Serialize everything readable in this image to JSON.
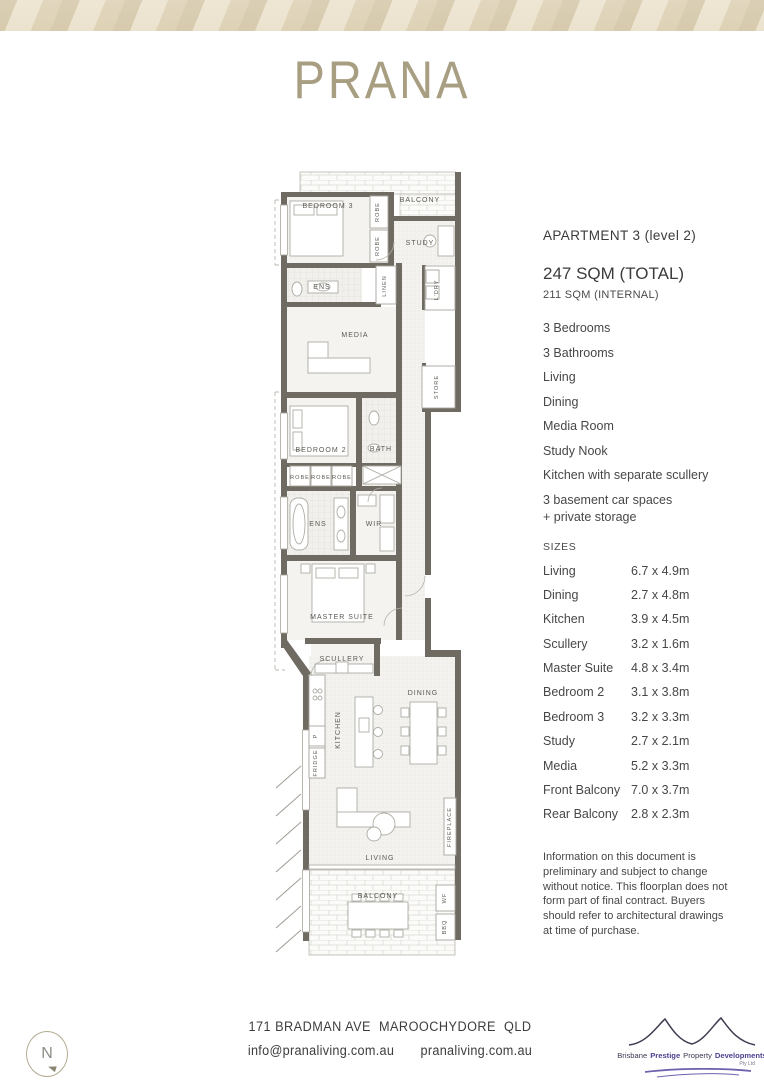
{
  "brand": {
    "logo_text": "PRANA"
  },
  "apartment": {
    "title": "APARTMENT 3 (level 2)",
    "area_total": "247 SQM (TOTAL)",
    "area_internal": "211 SQM (INTERNAL)",
    "features": [
      "3 Bedrooms",
      "3 Bathrooms",
      "Living",
      "Dining",
      "Media Room",
      "Study Nook",
      "Kitchen with separate scullery",
      "3 basement car spaces",
      "+ private storage"
    ]
  },
  "sizes": {
    "heading": "SIZES",
    "rows": [
      {
        "room": "Living",
        "dim": "6.7 x 4.9m"
      },
      {
        "room": "Dining",
        "dim": "2.7 x 4.8m"
      },
      {
        "room": "Kitchen",
        "dim": "3.9 x 4.5m"
      },
      {
        "room": "Scullery",
        "dim": "3.2 x 1.6m"
      },
      {
        "room": "Master Suite",
        "dim": "4.8 x 3.4m"
      },
      {
        "room": "Bedroom 2",
        "dim": "3.1 x 3.8m"
      },
      {
        "room": "Bedroom 3",
        "dim": "3.2 x 3.3m"
      },
      {
        "room": "Study",
        "dim": "2.7 x 2.1m"
      },
      {
        "room": "Media",
        "dim": "5.2 x 3.3m"
      },
      {
        "room": "Front Balcony",
        "dim": "7.0 x 3.7m"
      },
      {
        "room": "Rear Balcony",
        "dim": "2.8 x 2.3m"
      }
    ]
  },
  "disclaimer": "Information on this document is preliminary and subject to change without notice. This floorplan does not form part of final contract. Buyers should refer to architectural drawings at time of purchase.",
  "footer": {
    "address": "171 BRADMAN AVE  MAROOCHYDORE  QLD",
    "email": "info@pranaliving.com.au",
    "website": "pranaliving.com.au",
    "compass_letter": "N",
    "developer": {
      "word1": "Brisbane",
      "word2": "Prestige",
      "word3": "Property",
      "word4": "Developments",
      "sub": "Pty Ltd"
    }
  },
  "floorplan": {
    "labels": {
      "bedroom3": "BEDROOM 3",
      "robe": "ROBE",
      "balcony": "BALCONY",
      "study": "STUDY",
      "ens": "ENS",
      "linen": "LINEN",
      "laundry": "L'DRY",
      "media": "MEDIA",
      "store": "STORE",
      "bedroom2": "BEDROOM 2",
      "bath": "BATH",
      "wir": "WIR",
      "master": "MASTER SUITE",
      "scullery": "SCULLERY",
      "kitchen": "KITCHEN",
      "pantry": "P",
      "fridge": "FRIDGE",
      "dining": "DINING",
      "living": "LIVING",
      "fireplace": "FIREPLACE",
      "wf": "WF",
      "bbq": "BBQ"
    }
  },
  "colors": {
    "sand": "#e5dcc6",
    "brand_gold": "#a89e82",
    "wall": "#6f6a62",
    "text": "#3f3f3f"
  }
}
